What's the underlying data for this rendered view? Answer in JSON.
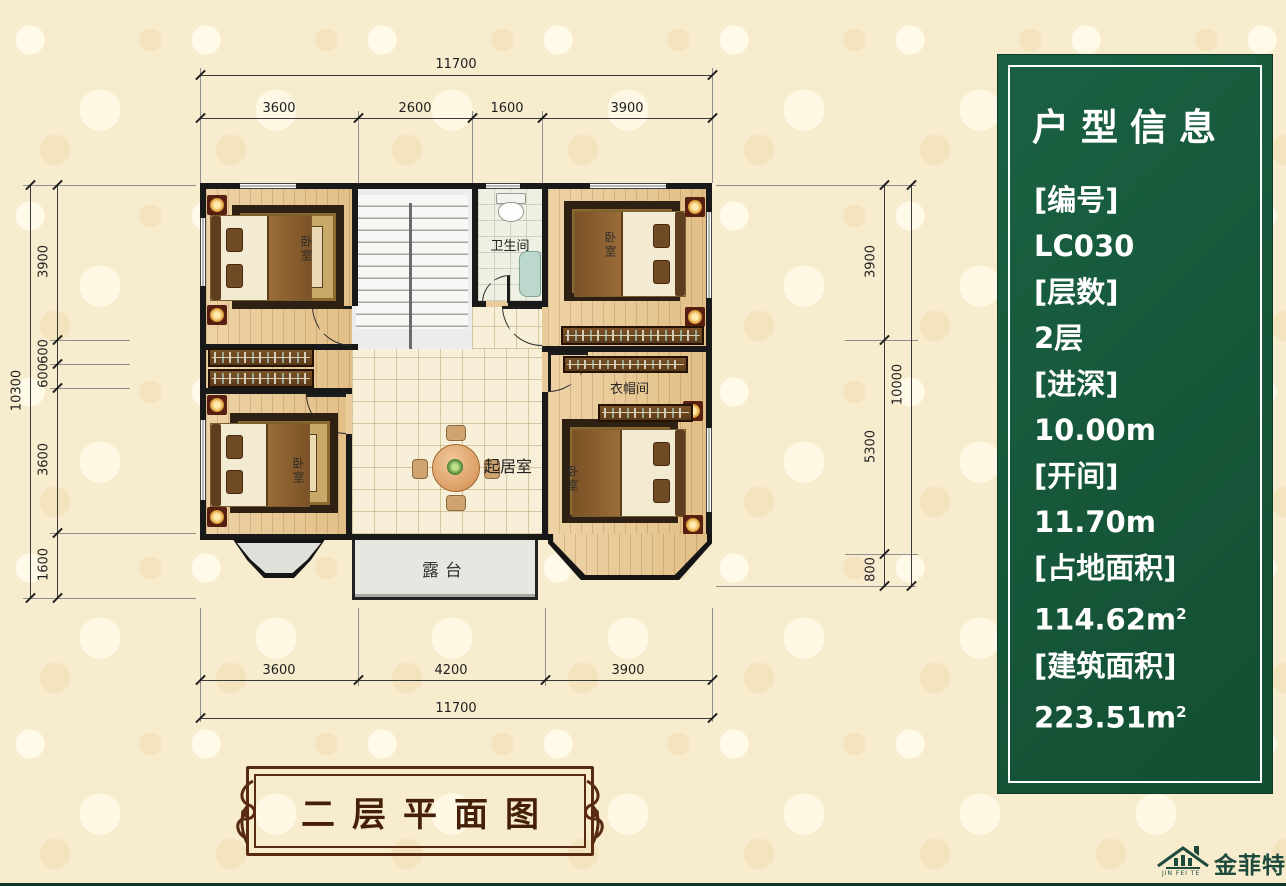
{
  "info_panel": {
    "title": "户型信息",
    "panel_color": "#15593A",
    "items": [
      {
        "text": "[编号]"
      },
      {
        "text": "LC030"
      },
      {
        "text": "[层数]"
      },
      {
        "text": "2层"
      },
      {
        "text": "[进深]"
      },
      {
        "text": "10.00m"
      },
      {
        "text": "[开间]"
      },
      {
        "text": "11.70m"
      },
      {
        "text": "[占地面积]"
      },
      {
        "text": "114.62m",
        "sup": "2"
      },
      {
        "text": "[建筑面积]"
      },
      {
        "text": "223.51m",
        "sup": "2"
      }
    ]
  },
  "rooms": {
    "bedroom": "卧室",
    "bathroom": "卫生间",
    "living_room": "起居室",
    "cloakroom": "衣帽间",
    "terrace": "露台"
  },
  "dims": {
    "top": {
      "total": "11700",
      "segments": [
        "3600",
        "2600",
        "1600",
        "3900"
      ]
    },
    "bottom": {
      "total": "11700",
      "segments": [
        "3600",
        "4200",
        "3900"
      ]
    },
    "left": {
      "total": "10300",
      "segments": [
        "3900",
        "600",
        "600",
        "3600",
        "1600"
      ]
    },
    "right": {
      "total": "10000",
      "segments": [
        "3900",
        "5300",
        "800"
      ]
    }
  },
  "banner": {
    "title": "二层平面图"
  },
  "brand": {
    "name": "金菲特",
    "sub": "JIN FEI TE"
  },
  "colors": {
    "panel_green": "#15593A",
    "banner_brown": "#582A11",
    "brand_teal": "#1D4A3C"
  }
}
